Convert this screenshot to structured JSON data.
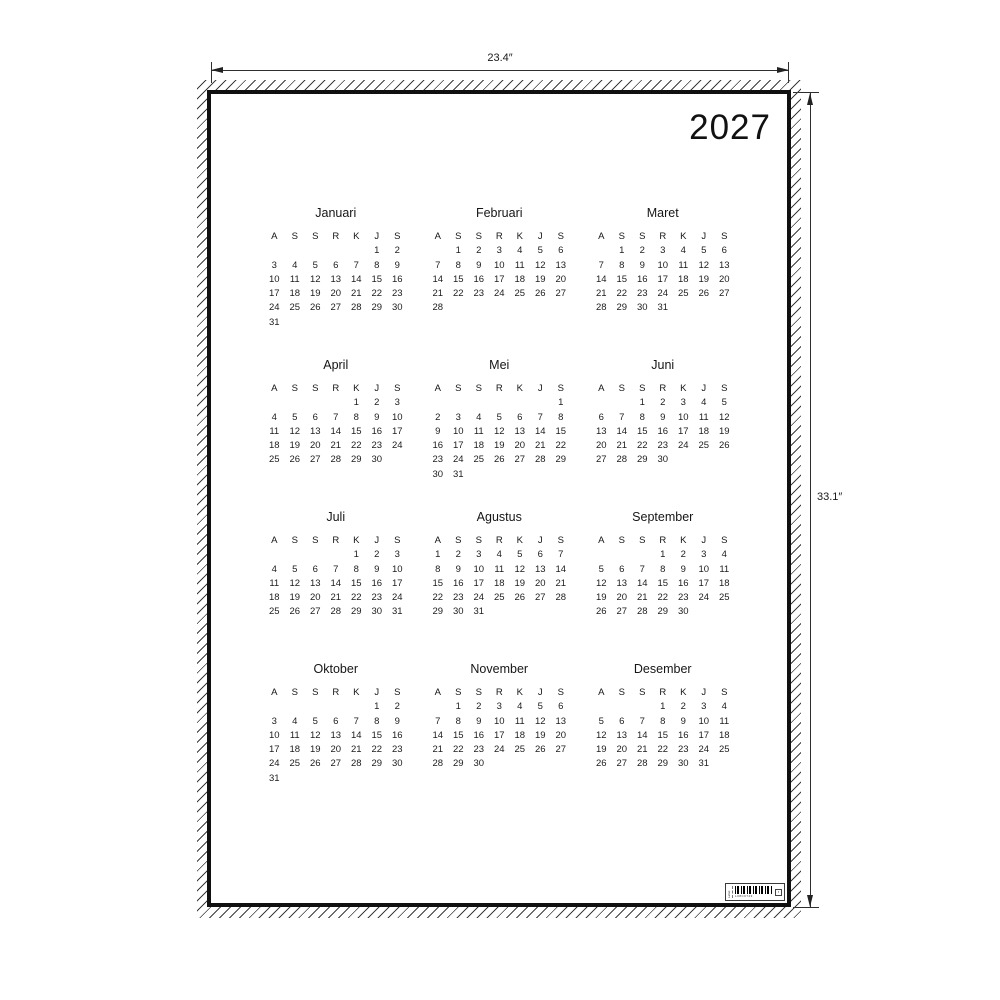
{
  "poster": {
    "year": "2027",
    "day_headers": [
      "A",
      "S",
      "S",
      "R",
      "K",
      "J",
      "S"
    ],
    "months": [
      {
        "name": "Januari",
        "weeks": [
          [
            "",
            "",
            "",
            "",
            "",
            "1",
            "2"
          ],
          [
            "3",
            "4",
            "5",
            "6",
            "7",
            "8",
            "9"
          ],
          [
            "10",
            "11",
            "12",
            "13",
            "14",
            "15",
            "16"
          ],
          [
            "17",
            "18",
            "19",
            "20",
            "21",
            "22",
            "23"
          ],
          [
            "24",
            "25",
            "26",
            "27",
            "28",
            "29",
            "30"
          ],
          [
            "31",
            "",
            "",
            "",
            "",
            "",
            ""
          ]
        ]
      },
      {
        "name": "Februari",
        "weeks": [
          [
            "",
            "1",
            "2",
            "3",
            "4",
            "5",
            "6"
          ],
          [
            "7",
            "8",
            "9",
            "10",
            "11",
            "12",
            "13"
          ],
          [
            "14",
            "15",
            "16",
            "17",
            "18",
            "19",
            "20"
          ],
          [
            "21",
            "22",
            "23",
            "24",
            "25",
            "26",
            "27"
          ],
          [
            "28",
            "",
            "",
            "",
            "",
            "",
            ""
          ]
        ]
      },
      {
        "name": "Maret",
        "weeks": [
          [
            "",
            "1",
            "2",
            "3",
            "4",
            "5",
            "6"
          ],
          [
            "7",
            "8",
            "9",
            "10",
            "11",
            "12",
            "13"
          ],
          [
            "14",
            "15",
            "16",
            "17",
            "18",
            "19",
            "20"
          ],
          [
            "21",
            "22",
            "23",
            "24",
            "25",
            "26",
            "27"
          ],
          [
            "28",
            "29",
            "30",
            "31",
            "",
            "",
            ""
          ]
        ]
      },
      {
        "name": "April",
        "weeks": [
          [
            "",
            "",
            "",
            "",
            "1",
            "2",
            "3"
          ],
          [
            "4",
            "5",
            "6",
            "7",
            "8",
            "9",
            "10"
          ],
          [
            "11",
            "12",
            "13",
            "14",
            "15",
            "16",
            "17"
          ],
          [
            "18",
            "19",
            "20",
            "21",
            "22",
            "23",
            "24"
          ],
          [
            "25",
            "26",
            "27",
            "28",
            "29",
            "30",
            ""
          ]
        ]
      },
      {
        "name": "Mei",
        "weeks": [
          [
            "",
            "",
            "",
            "",
            "",
            "",
            "1"
          ],
          [
            "2",
            "3",
            "4",
            "5",
            "6",
            "7",
            "8"
          ],
          [
            "9",
            "10",
            "11",
            "12",
            "13",
            "14",
            "15"
          ],
          [
            "16",
            "17",
            "18",
            "19",
            "20",
            "21",
            "22"
          ],
          [
            "23",
            "24",
            "25",
            "26",
            "27",
            "28",
            "29"
          ],
          [
            "30",
            "31",
            "",
            "",
            "",
            "",
            ""
          ]
        ]
      },
      {
        "name": "Juni",
        "weeks": [
          [
            "",
            "",
            "1",
            "2",
            "3",
            "4",
            "5"
          ],
          [
            "6",
            "7",
            "8",
            "9",
            "10",
            "11",
            "12"
          ],
          [
            "13",
            "14",
            "15",
            "16",
            "17",
            "18",
            "19"
          ],
          [
            "20",
            "21",
            "22",
            "23",
            "24",
            "25",
            "26"
          ],
          [
            "27",
            "28",
            "29",
            "30",
            "",
            "",
            ""
          ]
        ]
      },
      {
        "name": "Juli",
        "weeks": [
          [
            "",
            "",
            "",
            "",
            "1",
            "2",
            "3"
          ],
          [
            "4",
            "5",
            "6",
            "7",
            "8",
            "9",
            "10"
          ],
          [
            "11",
            "12",
            "13",
            "14",
            "15",
            "16",
            "17"
          ],
          [
            "18",
            "19",
            "20",
            "21",
            "22",
            "23",
            "24"
          ],
          [
            "25",
            "26",
            "27",
            "28",
            "29",
            "30",
            "31"
          ]
        ]
      },
      {
        "name": "Agustus",
        "weeks": [
          [
            "1",
            "2",
            "3",
            "4",
            "5",
            "6",
            "7"
          ],
          [
            "8",
            "9",
            "10",
            "11",
            "12",
            "13",
            "14"
          ],
          [
            "15",
            "16",
            "17",
            "18",
            "19",
            "20",
            "21"
          ],
          [
            "22",
            "23",
            "24",
            "25",
            "26",
            "27",
            "28"
          ],
          [
            "29",
            "30",
            "31",
            "",
            "",
            "",
            ""
          ]
        ]
      },
      {
        "name": "September",
        "weeks": [
          [
            "",
            "",
            "",
            "1",
            "2",
            "3",
            "4"
          ],
          [
            "5",
            "6",
            "7",
            "8",
            "9",
            "10",
            "11"
          ],
          [
            "12",
            "13",
            "14",
            "15",
            "16",
            "17",
            "18"
          ],
          [
            "19",
            "20",
            "21",
            "22",
            "23",
            "24",
            "25"
          ],
          [
            "26",
            "27",
            "28",
            "29",
            "30",
            "",
            ""
          ]
        ]
      },
      {
        "name": "Oktober",
        "weeks": [
          [
            "",
            "",
            "",
            "",
            "",
            "1",
            "2"
          ],
          [
            "3",
            "4",
            "5",
            "6",
            "7",
            "8",
            "9"
          ],
          [
            "10",
            "11",
            "12",
            "13",
            "14",
            "15",
            "16"
          ],
          [
            "17",
            "18",
            "19",
            "20",
            "21",
            "22",
            "23"
          ],
          [
            "24",
            "25",
            "26",
            "27",
            "28",
            "29",
            "30"
          ],
          [
            "31",
            "",
            "",
            "",
            "",
            "",
            ""
          ]
        ]
      },
      {
        "name": "November",
        "weeks": [
          [
            "",
            "1",
            "2",
            "3",
            "4",
            "5",
            "6"
          ],
          [
            "7",
            "8",
            "9",
            "10",
            "11",
            "12",
            "13"
          ],
          [
            "14",
            "15",
            "16",
            "17",
            "18",
            "19",
            "20"
          ],
          [
            "21",
            "22",
            "23",
            "24",
            "25",
            "26",
            "27"
          ],
          [
            "28",
            "29",
            "30",
            "",
            "",
            "",
            ""
          ]
        ]
      },
      {
        "name": "Desember",
        "weeks": [
          [
            "",
            "",
            "",
            "1",
            "2",
            "3",
            "4"
          ],
          [
            "5",
            "6",
            "7",
            "8",
            "9",
            "10",
            "11"
          ],
          [
            "12",
            "13",
            "14",
            "15",
            "16",
            "17",
            "18"
          ],
          [
            "19",
            "20",
            "21",
            "22",
            "23",
            "24",
            "25"
          ],
          [
            "26",
            "27",
            "28",
            "29",
            "30",
            "31",
            ""
          ]
        ]
      }
    ]
  },
  "dimensions": {
    "width_label": "23.4″",
    "height_label": "33.1″"
  },
  "barcode": {
    "side_text": "Label",
    "code_text": "L08C0743",
    "box_text": "▪"
  }
}
